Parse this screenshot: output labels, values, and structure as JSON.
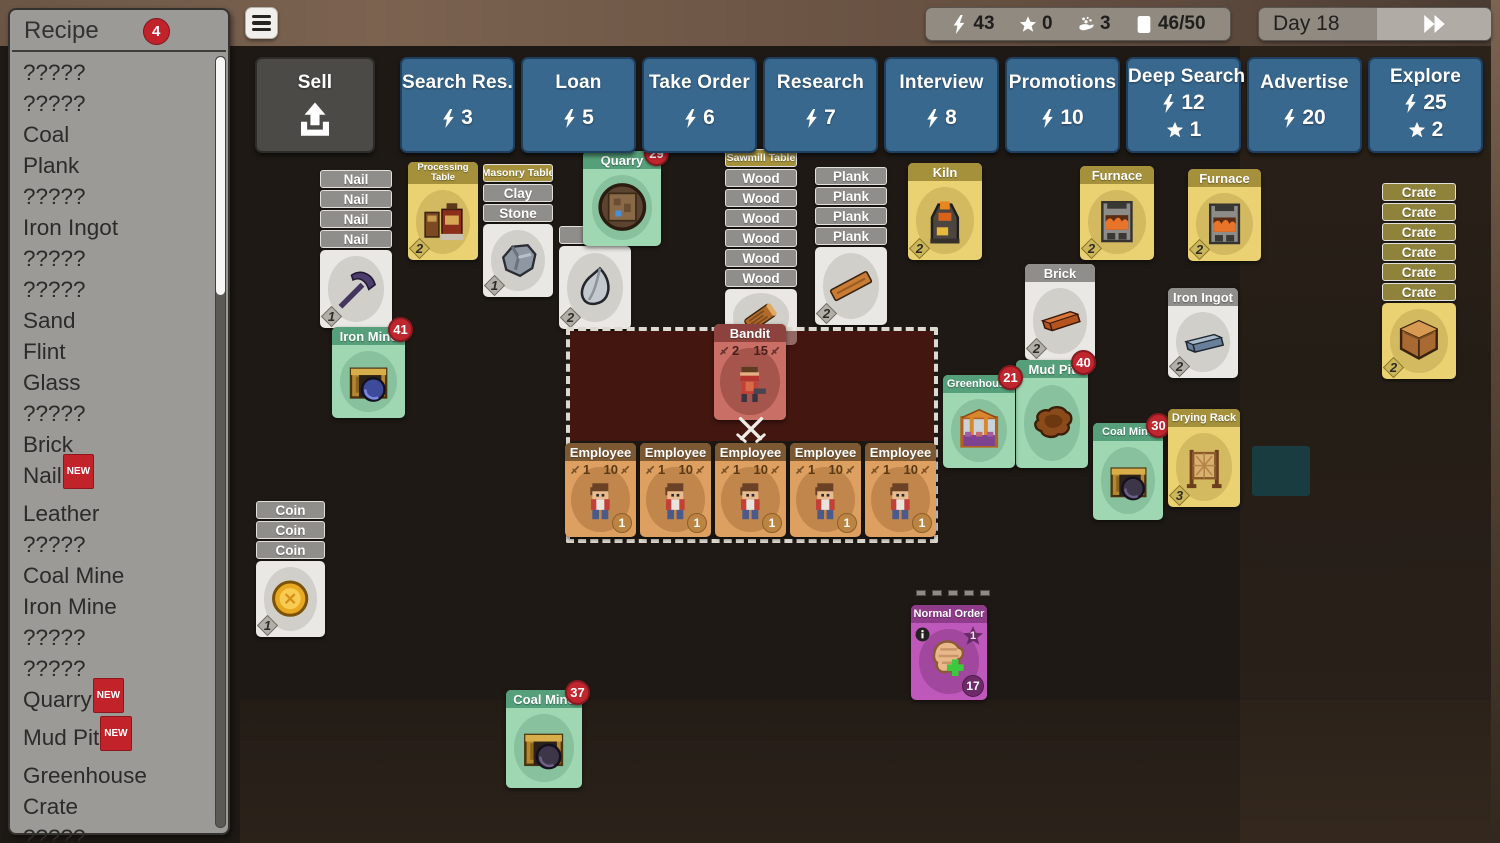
{
  "colors": {
    "action_blue": "#39688f",
    "card_mint": "#9ed7b2",
    "card_yellow": "#ead172",
    "card_red": "#ca6f66",
    "card_tan": "#dda061",
    "card_purple": "#bf58bb",
    "badge_red": "#c0262e",
    "bar_gray": "#908e8a",
    "top_strip_brown": "#6b5646",
    "background_dark": "#1e1914"
  },
  "recipe_panel": {
    "title": "Recipe",
    "badge": "4",
    "new_label": "NEW",
    "items": [
      {
        "label": "?????"
      },
      {
        "label": "?????"
      },
      {
        "label": "Coal"
      },
      {
        "label": "Plank"
      },
      {
        "label": "?????"
      },
      {
        "label": "Iron Ingot"
      },
      {
        "label": "?????"
      },
      {
        "label": "?????"
      },
      {
        "label": "Sand"
      },
      {
        "label": "Flint"
      },
      {
        "label": "Glass"
      },
      {
        "label": "?????"
      },
      {
        "label": "Brick"
      },
      {
        "label": "Nail",
        "new": true
      },
      {
        "label": "Leather"
      },
      {
        "label": "?????"
      },
      {
        "label": "Coal Mine"
      },
      {
        "label": "Iron Mine"
      },
      {
        "label": "?????"
      },
      {
        "label": "?????"
      },
      {
        "label": "Quarry",
        "new": true
      },
      {
        "label": "Mud Pit",
        "new": true
      },
      {
        "label": "Greenhouse"
      },
      {
        "label": "Crate"
      },
      {
        "label": "?????"
      }
    ]
  },
  "top_bar": {
    "menu_icon": "hamburger-icon",
    "stats": [
      {
        "icon": "lightning-icon",
        "value": "43"
      },
      {
        "icon": "star-icon",
        "value": "0"
      },
      {
        "icon": "worker-icon",
        "value": "3"
      },
      {
        "icon": "card-count-icon",
        "value": "46/50"
      }
    ],
    "day_label": "Day 18",
    "fast_forward_icon": "fast-forward-icon"
  },
  "action_bar": {
    "sell": {
      "label": "Sell",
      "icon": "sell-upload-icon"
    },
    "buttons": [
      {
        "label": "Search Res.",
        "energy": "3"
      },
      {
        "label": "Loan",
        "energy": "5"
      },
      {
        "label": "Take Order",
        "energy": "6"
      },
      {
        "label": "Research",
        "energy": "7"
      },
      {
        "label": "Interview",
        "energy": "8"
      },
      {
        "label": "Promotions",
        "energy": "10"
      },
      {
        "label": "Deep Search",
        "energy": "12",
        "star": "1"
      },
      {
        "label": "Advertise",
        "energy": "20"
      },
      {
        "label": "Explore",
        "energy": "25",
        "star": "2"
      }
    ]
  },
  "board": {
    "battle_icon": "crossed-swords-icon",
    "cards": [
      {
        "kind": "stack",
        "name": "nail-stack",
        "x": 320,
        "y": 170,
        "w": 72,
        "z": 2,
        "bars": [
          {
            "label": "Nail",
            "style": "gray"
          },
          {
            "label": "Nail",
            "style": "gray"
          },
          {
            "label": "Nail",
            "style": "gray"
          },
          {
            "label": "Nail",
            "style": "gray"
          }
        ],
        "face": {
          "style": "white",
          "h": 78,
          "art": "pickaxe-icon",
          "value": "1"
        }
      },
      {
        "kind": "titled",
        "name": "processing-table-card",
        "x": 408,
        "y": 162,
        "w": 70,
        "h": 98,
        "z": 2,
        "style": "yellow",
        "title": "Processing Table",
        "two_line": true,
        "art": "processing-machine-icon",
        "value": "2"
      },
      {
        "kind": "stack",
        "name": "masonry-table-stack",
        "x": 483,
        "y": 164,
        "w": 70,
        "z": 2,
        "bars": [
          {
            "label": "Masonry Table",
            "style": "olive",
            "small": true
          },
          {
            "label": "Clay",
            "style": "gray"
          },
          {
            "label": "Stone",
            "style": "gray"
          }
        ],
        "face": {
          "style": "white",
          "h": 73,
          "art": "stone-icon",
          "value": "1"
        }
      },
      {
        "kind": "stack",
        "name": "flint-card",
        "x": 559,
        "y": 226,
        "w": 72,
        "z": 1,
        "bars": [
          {
            "label": "",
            "style": "gray"
          }
        ],
        "face": {
          "style": "white",
          "h": 83,
          "art": "flint-icon",
          "value": "2"
        }
      },
      {
        "kind": "titled",
        "name": "quarry-card",
        "x": 583,
        "y": 151,
        "w": 78,
        "h": 95,
        "z": 2,
        "style": "mint",
        "title": "Quarry",
        "art": "quarry-icon",
        "badge": "29"
      },
      {
        "kind": "stack",
        "name": "sawmill-table-stack",
        "x": 725,
        "y": 149,
        "w": 72,
        "z": 2,
        "bars": [
          {
            "label": "Sawmill Table",
            "style": "olive",
            "small": true
          },
          {
            "label": "Wood",
            "style": "gray"
          },
          {
            "label": "Wood",
            "style": "gray"
          },
          {
            "label": "Wood",
            "style": "gray"
          },
          {
            "label": "Wood",
            "style": "gray"
          },
          {
            "label": "Wood",
            "style": "gray"
          },
          {
            "label": "Wood",
            "style": "gray"
          }
        ],
        "face": {
          "style": "white",
          "h": 56,
          "art": "log-icon"
        }
      },
      {
        "kind": "stack",
        "name": "plank-stack",
        "x": 815,
        "y": 167,
        "w": 72,
        "z": 2,
        "bars": [
          {
            "label": "Plank",
            "style": "gray"
          },
          {
            "label": "Plank",
            "style": "gray"
          },
          {
            "label": "Plank",
            "style": "gray"
          },
          {
            "label": "Plank",
            "style": "gray"
          }
        ],
        "face": {
          "style": "white",
          "h": 78,
          "art": "plank-icon",
          "value": "2"
        }
      },
      {
        "kind": "unit",
        "name": "bandit-card",
        "x": 714,
        "y": 324,
        "w": 72,
        "h": 96,
        "z": 5,
        "style": "red",
        "title": "Bandit",
        "atk": "2",
        "hp": "15",
        "art": "bandit-icon"
      },
      {
        "kind": "unit",
        "name": "employee-card-1",
        "x": 565,
        "y": 443,
        "w": 71,
        "h": 94,
        "z": 5,
        "style": "tan",
        "title": "Employee",
        "atk": "1",
        "hp": "10",
        "coin": "1",
        "art": "employee-icon"
      },
      {
        "kind": "unit",
        "name": "employee-card-2",
        "x": 640,
        "y": 443,
        "w": 71,
        "h": 94,
        "z": 5,
        "style": "tan",
        "title": "Employee",
        "atk": "1",
        "hp": "10",
        "coin": "1",
        "art": "employee-icon"
      },
      {
        "kind": "unit",
        "name": "employee-card-3",
        "x": 715,
        "y": 443,
        "w": 71,
        "h": 94,
        "z": 5,
        "style": "tan",
        "title": "Employee",
        "atk": "1",
        "hp": "10",
        "coin": "1",
        "art": "employee-icon"
      },
      {
        "kind": "unit",
        "name": "employee-card-4",
        "x": 790,
        "y": 443,
        "w": 71,
        "h": 94,
        "z": 5,
        "style": "tan",
        "title": "Employee",
        "atk": "1",
        "hp": "10",
        "coin": "1",
        "art": "employee-icon"
      },
      {
        "kind": "unit",
        "name": "employee-card-5",
        "x": 865,
        "y": 443,
        "w": 71,
        "h": 94,
        "z": 5,
        "style": "tan",
        "title": "Employee",
        "atk": "1",
        "hp": "10",
        "coin": "1",
        "art": "employee-icon"
      },
      {
        "kind": "titled",
        "name": "kiln-card",
        "x": 908,
        "y": 163,
        "w": 74,
        "h": 97,
        "z": 2,
        "style": "yellow",
        "title": "Kiln",
        "art": "kiln-icon",
        "value": "2"
      },
      {
        "kind": "titled",
        "name": "furnace-card-1",
        "x": 1080,
        "y": 166,
        "w": 74,
        "h": 94,
        "z": 2,
        "style": "yellow",
        "title": "Furnace",
        "art": "furnace-icon",
        "value": "2"
      },
      {
        "kind": "titled",
        "name": "furnace-card-2",
        "x": 1188,
        "y": 169,
        "w": 73,
        "h": 92,
        "z": 2,
        "style": "yellow",
        "title": "Furnace",
        "art": "furnace-icon",
        "value": "2"
      },
      {
        "kind": "titled",
        "name": "brick-card",
        "x": 1025,
        "y": 264,
        "w": 70,
        "h": 96,
        "z": 2,
        "style": "whitegray",
        "title": "Brick",
        "art": "brick-icon",
        "value": "2"
      },
      {
        "kind": "titled",
        "name": "iron-ingot-card",
        "x": 1168,
        "y": 288,
        "w": 70,
        "h": 90,
        "z": 2,
        "style": "whitegray",
        "title": "Iron Ingot",
        "art": "iron-ingot-icon",
        "value": "2"
      },
      {
        "kind": "stack",
        "name": "crate-stack",
        "x": 1382,
        "y": 183,
        "w": 74,
        "z": 2,
        "bars": [
          {
            "label": "Crate",
            "style": "crate"
          },
          {
            "label": "Crate",
            "style": "crate"
          },
          {
            "label": "Crate",
            "style": "crate"
          },
          {
            "label": "Crate",
            "style": "crate"
          },
          {
            "label": "Crate",
            "style": "crate"
          },
          {
            "label": "Crate",
            "style": "crate"
          }
        ],
        "face": {
          "style": "yellow",
          "h": 76,
          "art": "crate-icon",
          "value": "2"
        }
      },
      {
        "kind": "titled",
        "name": "greenhouse-card",
        "x": 943,
        "y": 375,
        "w": 72,
        "h": 93,
        "z": 5,
        "style": "mint",
        "title": "Greenhouse",
        "small_title": true,
        "art": "greenhouse-icon",
        "badge": "21"
      },
      {
        "kind": "titled",
        "name": "mud-pit-card",
        "x": 1016,
        "y": 360,
        "w": 72,
        "h": 108,
        "z": 3,
        "style": "mint",
        "title": "Mud Pit",
        "art": "mud-pit-icon",
        "badge": "40"
      },
      {
        "kind": "titled",
        "name": "coal-mine-card-1",
        "x": 1093,
        "y": 423,
        "w": 70,
        "h": 97,
        "z": 3,
        "style": "mint",
        "title": "Coal Mine",
        "small_title": true,
        "art": "coal-mine-icon",
        "badge": "30"
      },
      {
        "kind": "titled",
        "name": "drying-rack-card",
        "x": 1168,
        "y": 409,
        "w": 72,
        "h": 98,
        "z": 4,
        "style": "yellow",
        "title": "Drying Rack",
        "small_title": true,
        "art": "drying-rack-icon",
        "value": "3"
      },
      {
        "kind": "titled",
        "name": "iron-mine-card",
        "x": 332,
        "y": 327,
        "w": 73,
        "h": 91,
        "z": 2,
        "style": "mint",
        "title": "Iron Mine",
        "art": "iron-mine-icon",
        "badge": "41"
      },
      {
        "kind": "stack",
        "name": "coin-stack",
        "x": 256,
        "y": 501,
        "w": 69,
        "z": 2,
        "bars": [
          {
            "label": "Coin",
            "style": "gray"
          },
          {
            "label": "Coin",
            "style": "gray"
          },
          {
            "label": "Coin",
            "style": "gray"
          }
        ],
        "face": {
          "style": "white",
          "h": 76,
          "art": "coin-icon",
          "value": "1"
        }
      },
      {
        "kind": "order",
        "name": "normal-order-card",
        "x": 911,
        "y": 605,
        "w": 76,
        "h": 95,
        "z": 3,
        "style": "purple",
        "title": "Normal Order",
        "star": "1",
        "badge": "17",
        "pips": 5,
        "art": "leather-order-icon",
        "info_icon": "info-icon"
      },
      {
        "kind": "titled",
        "name": "coal-mine-card-2",
        "x": 506,
        "y": 690,
        "w": 76,
        "h": 98,
        "z": 2,
        "style": "mint",
        "title": "Coal Mine",
        "art": "coal-mine-icon",
        "badge": "37"
      }
    ]
  }
}
